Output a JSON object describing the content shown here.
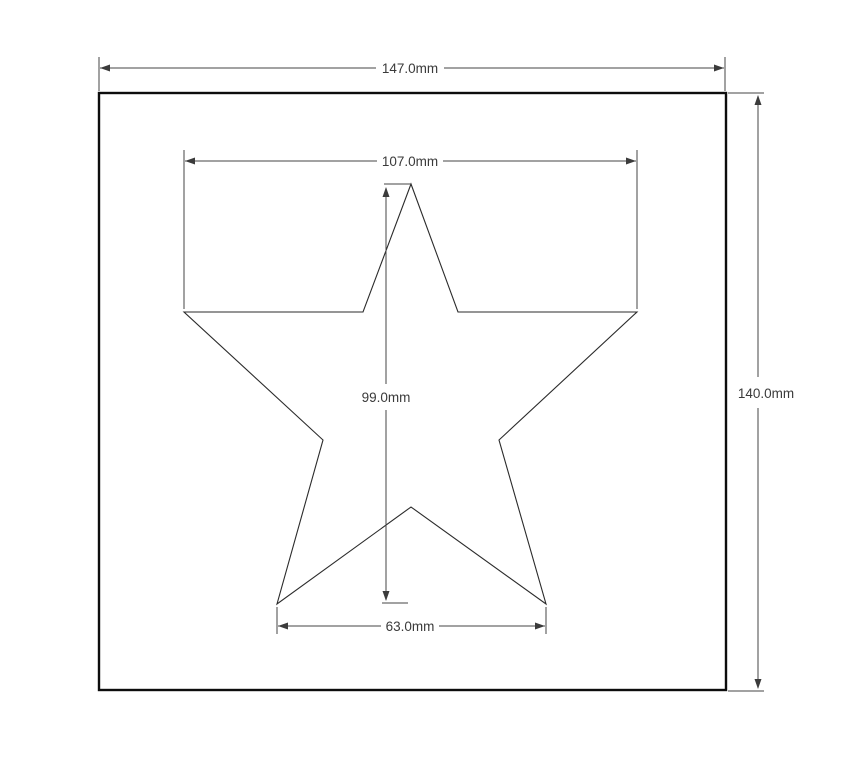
{
  "drawing": {
    "type": "cad-dimensioned-drawing",
    "background": "#ffffff",
    "colors": {
      "plate_outline": "#0d0d0d",
      "star_outline": "#2b2b2b",
      "dimension_lines": "#454545",
      "dimension_text": "#3a3a3a"
    },
    "shapes": {
      "plate": {
        "kind": "rectangle"
      },
      "cutout": {
        "kind": "five-point-star"
      }
    },
    "dimensions": {
      "plate_width": {
        "label": "147.0mm",
        "value": 147.0,
        "unit": "mm",
        "orientation": "horizontal"
      },
      "plate_height": {
        "label": "140.0mm",
        "value": 140.0,
        "unit": "mm",
        "orientation": "vertical"
      },
      "star_width": {
        "label": "107.0mm",
        "value": 107.0,
        "unit": "mm",
        "orientation": "horizontal"
      },
      "star_height": {
        "label": "99.0mm",
        "value": 99.0,
        "unit": "mm",
        "orientation": "vertical"
      },
      "star_base_width": {
        "label": "63.0mm",
        "value": 63.0,
        "unit": "mm",
        "orientation": "horizontal"
      }
    }
  }
}
